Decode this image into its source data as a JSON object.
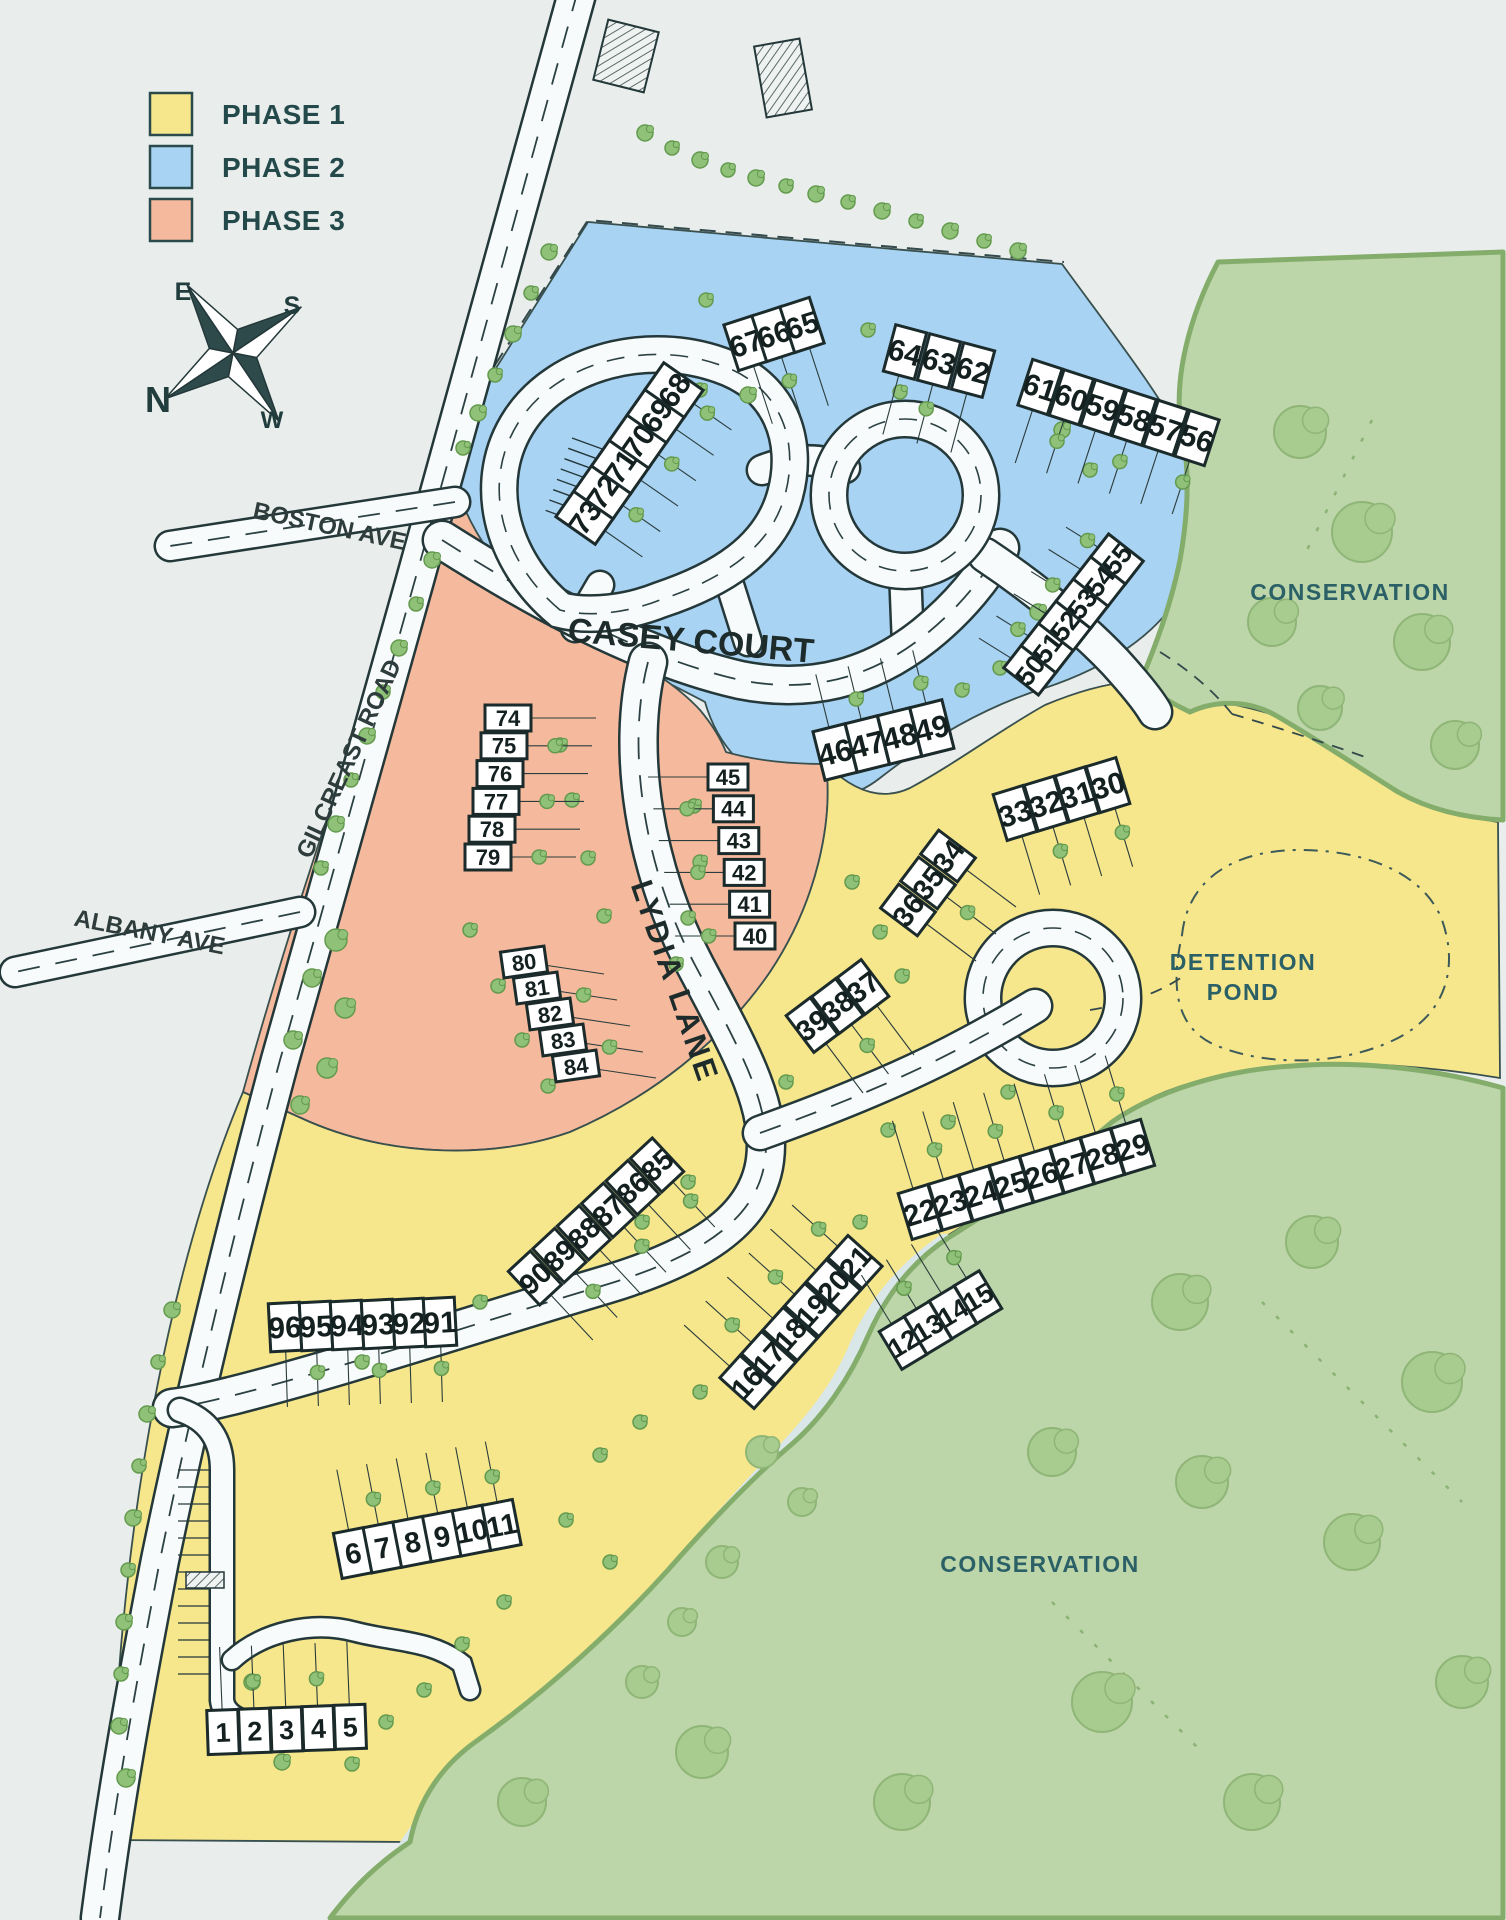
{
  "legend": {
    "items": [
      {
        "label": "PHASE 1",
        "color": "#f6e68c"
      },
      {
        "label": "PHASE 2",
        "color": "#a9d3f3"
      },
      {
        "label": "PHASE 3",
        "color": "#f5ba9d"
      }
    ]
  },
  "compass": {
    "n": "N",
    "s": "S",
    "e": "E",
    "w": "W"
  },
  "roads": {
    "boston": "BOSTON AVE",
    "gilcreast": "GILCREAST ROAD",
    "albany": "ALBANY AVE",
    "casey": "CASEY COURT",
    "lydia": "LYDIA LANE"
  },
  "areas": {
    "conservation_top": "CONSERVATION",
    "conservation_bottom": "CONSERVATION",
    "detention": [
      "DETENTION",
      "POND"
    ]
  },
  "colors": {
    "phase1": "#f6e68c",
    "phase2": "#a9d3f3",
    "phase3": "#f5ba9d",
    "conservation": "#bcd5a9",
    "conservation_edge": "#84ad6b",
    "road_fill": "#f8fbfb",
    "outline": "#24383a",
    "background": "#e9eeec",
    "tree": "#8fc178",
    "tree_edge": "#639a4e",
    "label_teal": "#2b6066"
  },
  "lots": {
    "clusters": [
      {
        "id": "lots-73-68",
        "phase": 2,
        "numbers": [
          "73",
          "72",
          "71",
          "70",
          "69",
          "68"
        ],
        "x": 585,
        "y": 517,
        "dx": 17.8,
        "dy": -25.4,
        "w": 33,
        "h": 48,
        "angle": -55,
        "tail": [
          0.82,
          0.57,
          70
        ]
      },
      {
        "id": "lots-67-65",
        "phase": 2,
        "numbers": [
          "67",
          "66",
          "65"
        ],
        "x": 746,
        "y": 343,
        "dx": 28,
        "dy": -9,
        "w": 31,
        "h": 48,
        "angle": -18,
        "tail": [
          0.31,
          0.95,
          85
        ]
      },
      {
        "id": "lots-64-62",
        "phase": 2,
        "numbers": [
          "64",
          "63",
          "62"
        ],
        "x": 905,
        "y": 352,
        "dx": 34,
        "dy": 9,
        "w": 32,
        "h": 48,
        "angle": 15,
        "tail": [
          -0.26,
          0.97,
          85
        ]
      },
      {
        "id": "lots-61-56",
        "phase": 2,
        "numbers": [
          "61",
          "60",
          "59",
          "58",
          "57",
          "56"
        ],
        "x": 1040,
        "y": 387,
        "dx": 31.4,
        "dy": 10.2,
        "w": 31,
        "h": 48,
        "angle": 18,
        "tail": [
          -0.31,
          0.95,
          80
        ]
      },
      {
        "id": "lots-50-55",
        "phase": 2,
        "numbers": [
          "50",
          "51",
          "52",
          "53",
          "54",
          "55"
        ],
        "x": 1030,
        "y": 670,
        "dx": 17.4,
        "dy": -22.2,
        "w": 29,
        "h": 44,
        "angle": -52,
        "tail": [
          -0.85,
          -0.53,
          60
        ]
      },
      {
        "id": "lots-46-49",
        "phase": 2,
        "numbers": [
          "46",
          "47",
          "48",
          "49"
        ],
        "x": 835,
        "y": 752,
        "dx": 32.3,
        "dy": -8,
        "w": 33,
        "h": 50,
        "angle": -14,
        "tail": [
          -0.24,
          -0.97,
          80
        ]
      },
      {
        "id": "lots-74-79",
        "phase": 3,
        "numbers": [
          "74",
          "75",
          "76",
          "77",
          "78",
          "79"
        ],
        "x": 508,
        "y": 718,
        "dx": -4,
        "dy": 27.8,
        "w": 46,
        "h": 26,
        "angle": 0,
        "tail": [
          1,
          0,
          88
        ]
      },
      {
        "id": "lots-45-40",
        "phase": 3,
        "numbers": [
          "45",
          "44",
          "43",
          "42",
          "41",
          "40"
        ],
        "x": 728,
        "y": 777,
        "dx": 5.4,
        "dy": 31.8,
        "w": 40,
        "h": 26,
        "angle": 0,
        "tail": [
          -1,
          0,
          80
        ]
      },
      {
        "id": "lots-80-84",
        "phase": 3,
        "numbers": [
          "80",
          "81",
          "82",
          "83",
          "84"
        ],
        "x": 524,
        "y": 962,
        "dx": 13,
        "dy": 26,
        "w": 44,
        "h": 26,
        "angle": -8,
        "tail": [
          1,
          0.15,
          80
        ]
      },
      {
        "id": "lots-33-30",
        "phase": 1,
        "numbers": [
          "33",
          "32",
          "31",
          "30"
        ],
        "x": 1015,
        "y": 813,
        "dx": 31,
        "dy": -9.3,
        "w": 31,
        "h": 48,
        "angle": -17,
        "tail": [
          0.29,
          0.96,
          85
        ]
      },
      {
        "id": "lots-36-34",
        "phase": 1,
        "numbers": [
          "36",
          "35",
          "34"
        ],
        "x": 908,
        "y": 910,
        "dx": 20,
        "dy": -27,
        "w": 30,
        "h": 46,
        "angle": -53,
        "tail": [
          0.8,
          0.6,
          85
        ]
      },
      {
        "id": "lots-39-37",
        "phase": 1,
        "numbers": [
          "39",
          "38",
          "37"
        ],
        "x": 812,
        "y": 1025,
        "dx": 25.5,
        "dy": -19,
        "w": 30,
        "h": 46,
        "angle": -37,
        "tail": [
          0.6,
          0.8,
          85
        ]
      },
      {
        "id": "lots-22-29",
        "phase": 1,
        "numbers": [
          "22",
          "23",
          "24",
          "25",
          "26",
          "27",
          "28",
          "29"
        ],
        "x": 920,
        "y": 1212,
        "dx": 30.4,
        "dy": -9.3,
        "w": 31,
        "h": 48,
        "angle": -17,
        "tail": [
          -0.29,
          -0.96,
          95
        ]
      },
      {
        "id": "lots-16-21",
        "phase": 1,
        "numbers": [
          "16",
          "17",
          "18",
          "19",
          "20",
          "21"
        ],
        "x": 747,
        "y": 1382,
        "dx": 21.6,
        "dy": -24,
        "w": 30,
        "h": 46,
        "angle": -48,
        "tail": [
          -0.74,
          -0.67,
          85
        ]
      },
      {
        "id": "lots-12-15",
        "phase": 1,
        "numbers": [
          "12",
          "13",
          "14",
          "15"
        ],
        "x": 903,
        "y": 1343,
        "dx": 25,
        "dy": -15.3,
        "w": 29,
        "h": 44,
        "angle": -31,
        "tail": [
          -0.52,
          -0.85,
          80
        ]
      },
      {
        "id": "lots-90-85",
        "phase": 1,
        "numbers": [
          "90",
          "89",
          "88",
          "87",
          "86",
          "85"
        ],
        "x": 535,
        "y": 1278,
        "dx": 24.4,
        "dy": -22.6,
        "w": 30,
        "h": 46,
        "angle": -43,
        "tail": [
          0.68,
          0.73,
          85
        ]
      },
      {
        "id": "lots-96-91",
        "phase": 1,
        "numbers": [
          "96",
          "95",
          "94",
          "93",
          "92",
          "91"
        ],
        "x": 285,
        "y": 1327,
        "dx": 31,
        "dy": -1,
        "w": 31,
        "h": 48,
        "angle": -3,
        "tail": [
          0.03,
          1,
          80
        ]
      },
      {
        "id": "lots-6-11",
        "phase": 1,
        "numbers": [
          "6",
          "7",
          "8",
          "9",
          "10",
          "11"
        ],
        "x": 353,
        "y": 1553,
        "dx": 29.7,
        "dy": -5.6,
        "w": 31,
        "h": 46,
        "angle": -11,
        "tail": [
          -0.19,
          -0.98,
          85
        ]
      },
      {
        "id": "lots-1-5",
        "phase": 1,
        "numbers": [
          "1",
          "2",
          "3",
          "4",
          "5"
        ],
        "x": 223,
        "y": 1732,
        "dx": 31.8,
        "dy": -1.3,
        "w": 31,
        "h": 44,
        "angle": -2,
        "tail": [
          -0.04,
          -1,
          85
        ]
      }
    ]
  }
}
